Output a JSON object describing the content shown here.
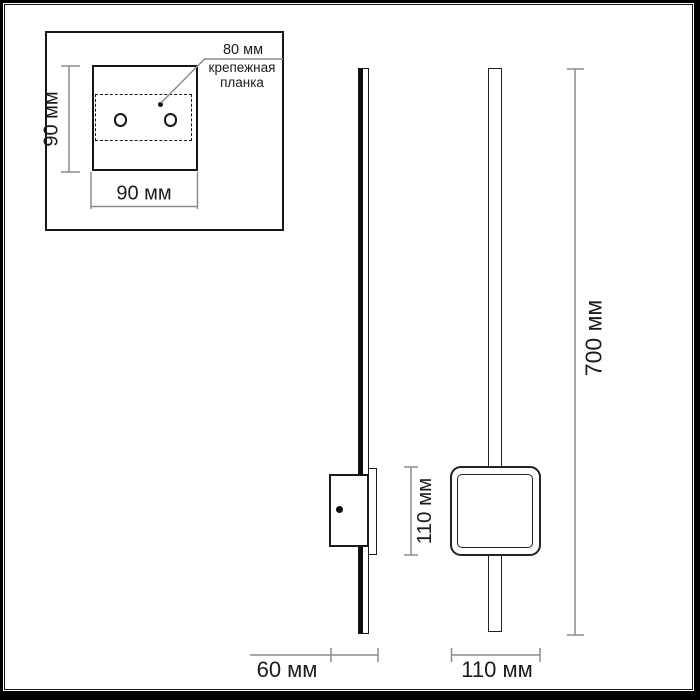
{
  "inset": {
    "spacing_label": "80 мм",
    "plate_note_line1": "крепежная",
    "plate_note_line2": "планка",
    "height_label": "90 мм",
    "width_label": "90 мм"
  },
  "side_view": {
    "depth_label": "60 мм",
    "bracket_height_label": "110 мм"
  },
  "front_view": {
    "width_label": "110 мм",
    "height_label": "700 мм"
  },
  "colors": {
    "outline": "#1a1a1a",
    "dimension_line": "#8c8c8c",
    "background": "#ffffff"
  }
}
